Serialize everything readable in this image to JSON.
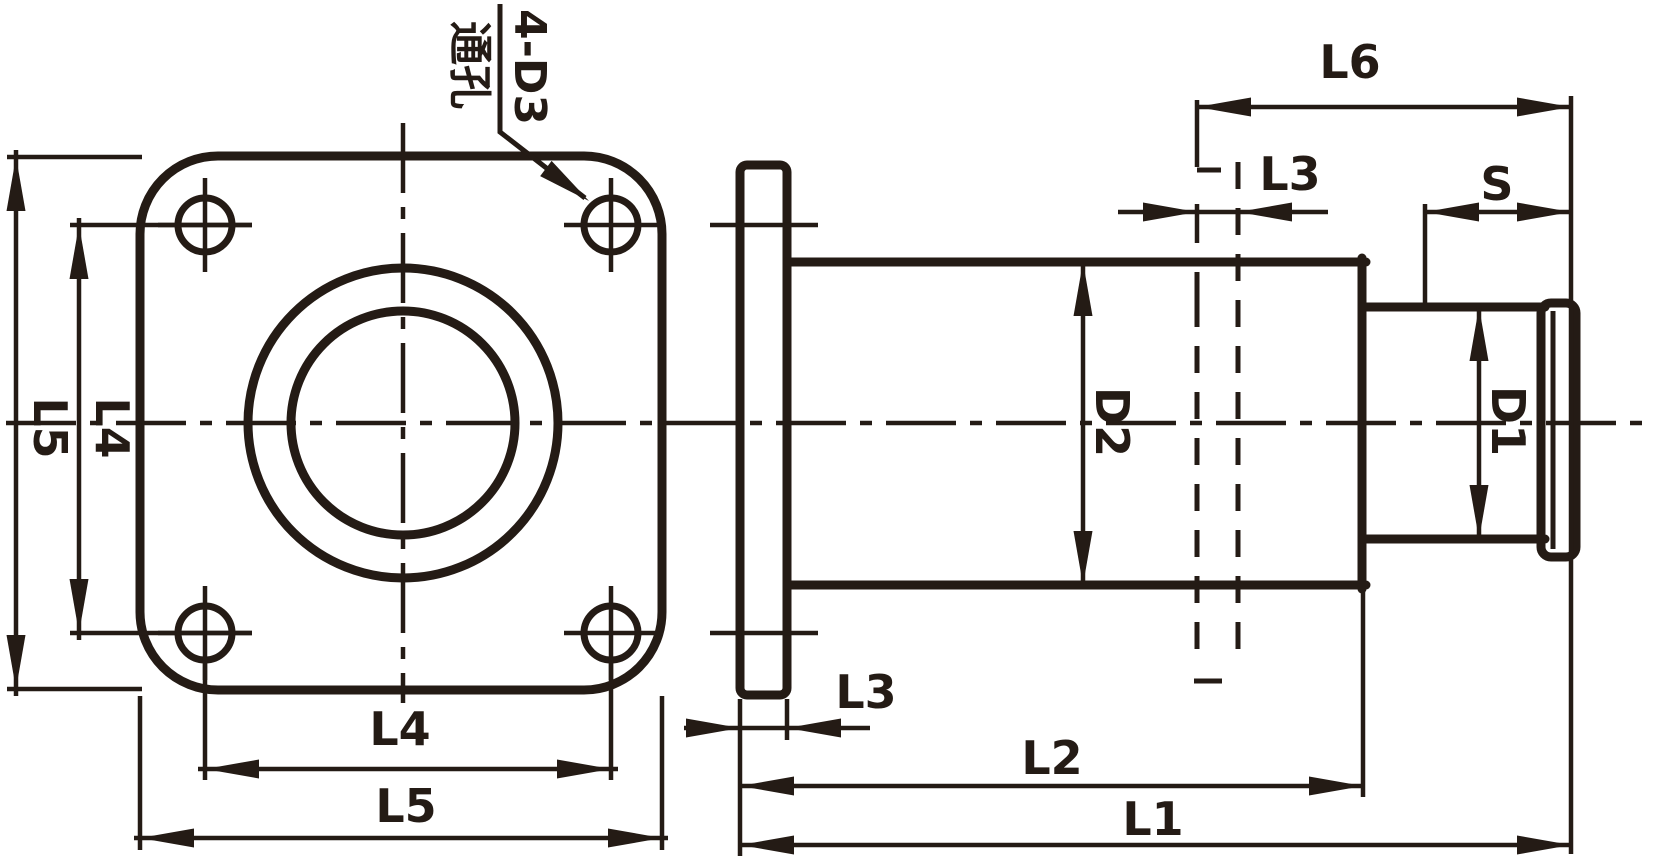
{
  "drawing": {
    "title_hint": "flanged-coupling-dimension-drawing",
    "colors": {
      "ink": "#241b15",
      "background": "#ffffff"
    },
    "callout": {
      "line1": "4-D3",
      "line2": "通孔"
    },
    "front_view": {
      "dims": {
        "l5_vertical": "L5",
        "l4_vertical": "L4",
        "l4_horizontal": "L4",
        "l5_horizontal": "L5"
      }
    },
    "side_view": {
      "dims": {
        "l6": "L6",
        "l3_top": "L3",
        "s": "S",
        "d2": "D2",
        "d1": "D1",
        "l3_bottom": "L3",
        "l2": "L2",
        "l1": "L1"
      }
    }
  }
}
